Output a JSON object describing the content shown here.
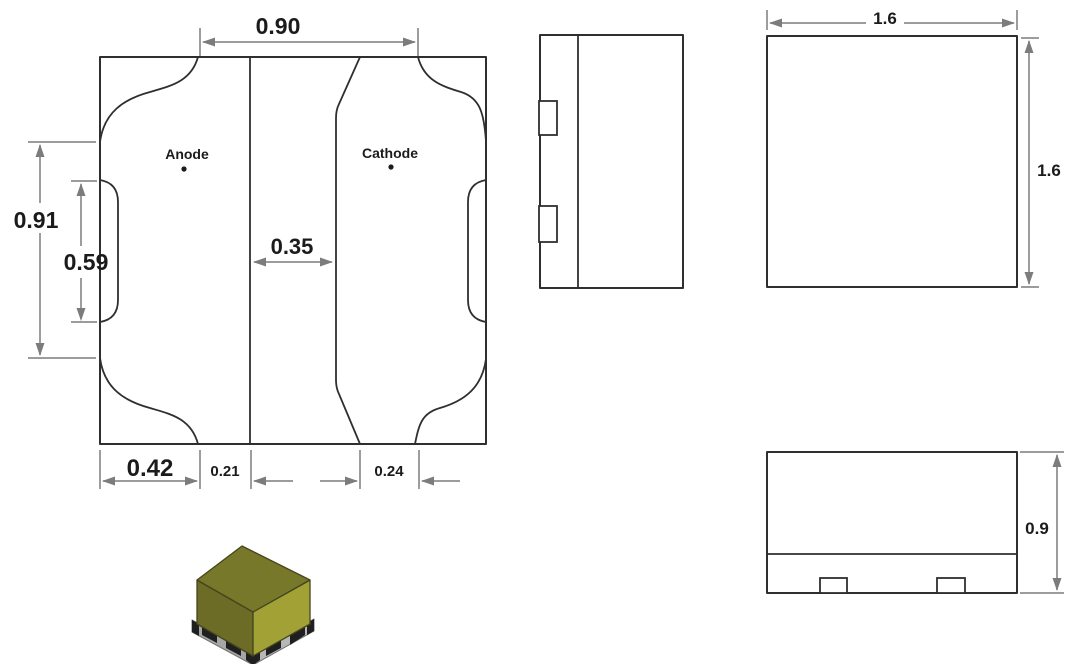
{
  "footprint_view": {
    "anode_label": "Anode",
    "cathode_label": "Cathode",
    "dim_top_width": "0.90",
    "dim_outer_height": "0.91",
    "dim_inner_height": "0.59",
    "dim_pad_gap": "0.35",
    "dim_bottom_width": "0.42",
    "dim_bottom_offset_left": "0.21",
    "dim_bottom_offset_right": "0.24"
  },
  "top_view": {
    "dim_width": "1.6",
    "dim_height": "1.6"
  },
  "front_view": {
    "dim_height": "0.9"
  },
  "colors": {
    "drawing_line": "#2f2f2f",
    "dimension_line": "#7c7c7c",
    "label_text": "#1b1b1b",
    "iso_top_face": "#78782a",
    "iso_left_face": "#6c6c26",
    "iso_right_face": "#a1a136",
    "iso_base": "#b7b7b7",
    "iso_base_dark": "#a6a6a6",
    "iso_contact_pad": "#1f1f1f"
  }
}
